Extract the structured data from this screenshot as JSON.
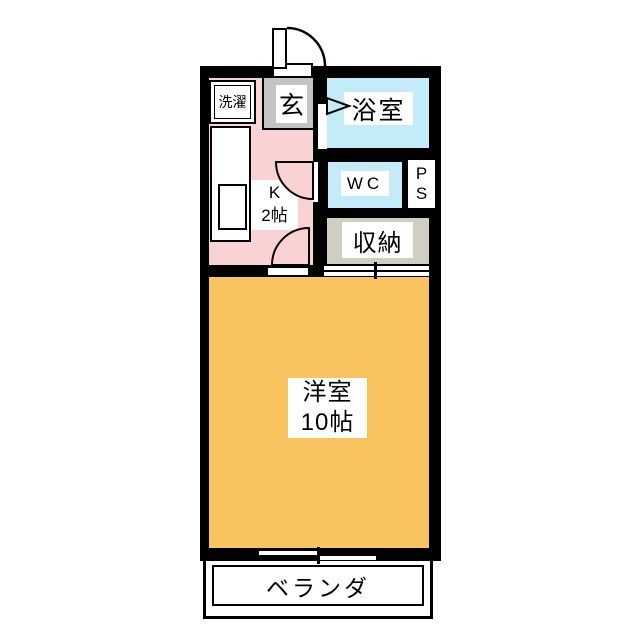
{
  "title": "1K apartment floor plan",
  "colors": {
    "wall": "#000000",
    "paper": "#ffffff",
    "kitchen": "#f9d3d3",
    "entrance": "#c4c4c4",
    "water": "#c4ebf8",
    "closet": "#d2cdc1",
    "main-room": "#f9c45f"
  },
  "rooms": {
    "laundry": {
      "label": "洗濯"
    },
    "entrance": {
      "label": "玄"
    },
    "bathroom": {
      "label": "浴室"
    },
    "toilet": {
      "label": "WC"
    },
    "pipe_space": {
      "line1": "P",
      "line2": "S"
    },
    "closet": {
      "label": "収納"
    },
    "kitchen": {
      "line1": "K",
      "line2": "2帖"
    },
    "main_room": {
      "line1": "洋室",
      "line2": "10帖"
    },
    "veranda": {
      "label": "ベランダ"
    }
  }
}
